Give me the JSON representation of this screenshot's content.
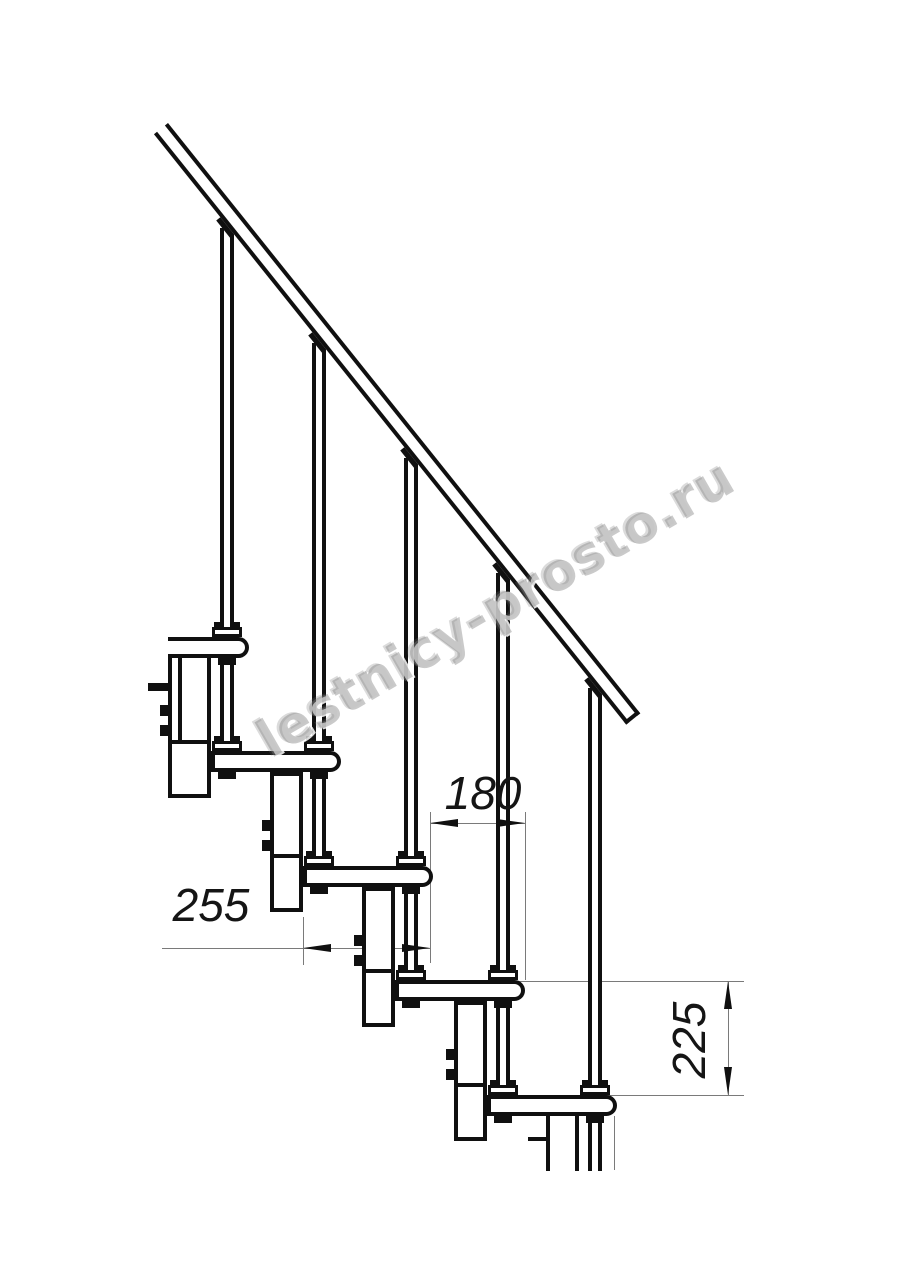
{
  "watermark": {
    "text": "lestnicy-prosto.ru"
  },
  "dimensions": {
    "step_run": {
      "value": "180",
      "orientation": "horizontal",
      "unit": "mm"
    },
    "tread_depth": {
      "value": "255",
      "orientation": "horizontal",
      "unit": "mm"
    },
    "step_rise": {
      "value": "225",
      "orientation": "vertical",
      "unit": "mm"
    }
  },
  "drawing": {
    "type": "staircase-side-view",
    "steps_visible": 5,
    "elements": [
      "handrail",
      "balusters",
      "treads",
      "support-posts",
      "support-boxes",
      "bolt-tabs"
    ],
    "colors": {
      "line": "#101010",
      "thin_line": "#7a7a7a",
      "background": "#ffffff",
      "watermark": "#9a9a9a"
    }
  }
}
